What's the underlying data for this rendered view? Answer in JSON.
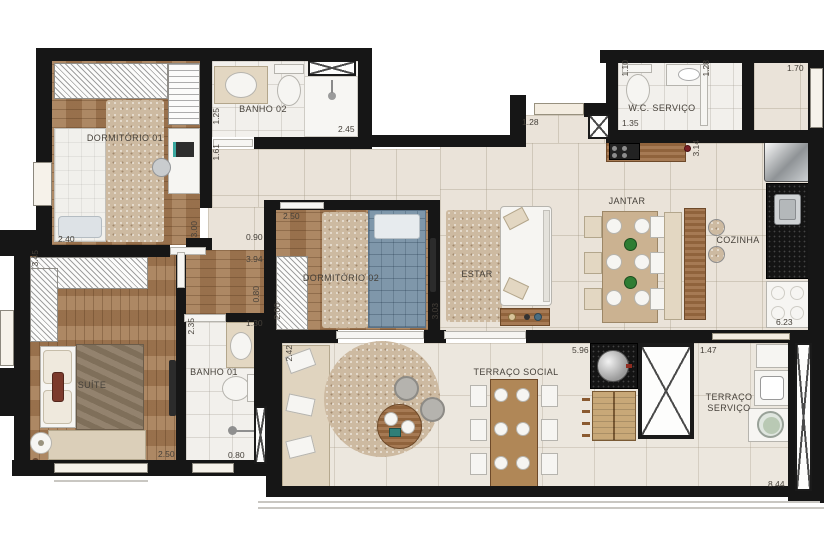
{
  "floorplan": {
    "rooms": [
      {
        "id": "dormitorio-01",
        "label": "DORMITÓRIO 01"
      },
      {
        "id": "banho-02",
        "label": "BANHO 02"
      },
      {
        "id": "wc-servico",
        "label": "W.C. SERVIÇO"
      },
      {
        "id": "jantar",
        "label": "JANTAR"
      },
      {
        "id": "cozinha",
        "label": "COZINHA"
      },
      {
        "id": "estar",
        "label": "ESTAR"
      },
      {
        "id": "dormitorio-02",
        "label": "DORMITÓRIO 02"
      },
      {
        "id": "suite",
        "label": "SUÍTE"
      },
      {
        "id": "banho-01",
        "label": "BANHO 01"
      },
      {
        "id": "terraco-social",
        "label": "TERRAÇO SOCIAL"
      },
      {
        "id": "terraco-servico",
        "label": "TERRAÇO SERVIÇO"
      }
    ],
    "dimensions_m": [
      {
        "id": "dorm01-width",
        "value": "2.40"
      },
      {
        "id": "banho02-left",
        "value": "1.25"
      },
      {
        "id": "hall-left",
        "value": "1.61"
      },
      {
        "id": "banho02-width",
        "value": "2.45"
      },
      {
        "id": "corridor-a",
        "value": "3.00"
      },
      {
        "id": "corridor-b",
        "value": "0.90"
      },
      {
        "id": "corridor-c",
        "value": "3.94"
      },
      {
        "id": "corridor-d",
        "value": "0.80"
      },
      {
        "id": "dorm02-width",
        "value": "2.50"
      },
      {
        "id": "dorm02-left",
        "value": "2.00"
      },
      {
        "id": "dorm02-right",
        "value": "3.03"
      },
      {
        "id": "wc-left",
        "value": "1.10"
      },
      {
        "id": "wc-bottom",
        "value": "1.35"
      },
      {
        "id": "entry",
        "value": "1.28"
      },
      {
        "id": "wc-right",
        "value": "1.28"
      },
      {
        "id": "top-right",
        "value": "1.70"
      },
      {
        "id": "kitchen-island",
        "value": "3.14"
      },
      {
        "id": "cozinha-depth",
        "value": "6.23"
      },
      {
        "id": "suite-left",
        "value": "3.45"
      },
      {
        "id": "suite-width",
        "value": "2.50"
      },
      {
        "id": "banho01-left",
        "value": "2.35"
      },
      {
        "id": "banho01-top",
        "value": "1.30"
      },
      {
        "id": "banho01-bottom",
        "value": "0.80"
      },
      {
        "id": "terraco-left",
        "value": "2.42"
      },
      {
        "id": "terraco-width",
        "value": "5.96"
      },
      {
        "id": "servico-width",
        "value": "1.47"
      },
      {
        "id": "terraco-total",
        "value": "8.44"
      }
    ],
    "colors": {
      "wall": "#161616",
      "wood_floor": "#a57c55",
      "tile_living": "#eae3d9",
      "tile_bath": "#f2f0ec",
      "tile_terrace": "#ece7de",
      "bed_blue": "#7f97aa",
      "bed_suite": "#8a7862",
      "rug": "#cdbaa1",
      "furniture_wood": "#9c6b41",
      "counter_black": "#141414",
      "label_text": "#46413a"
    }
  }
}
